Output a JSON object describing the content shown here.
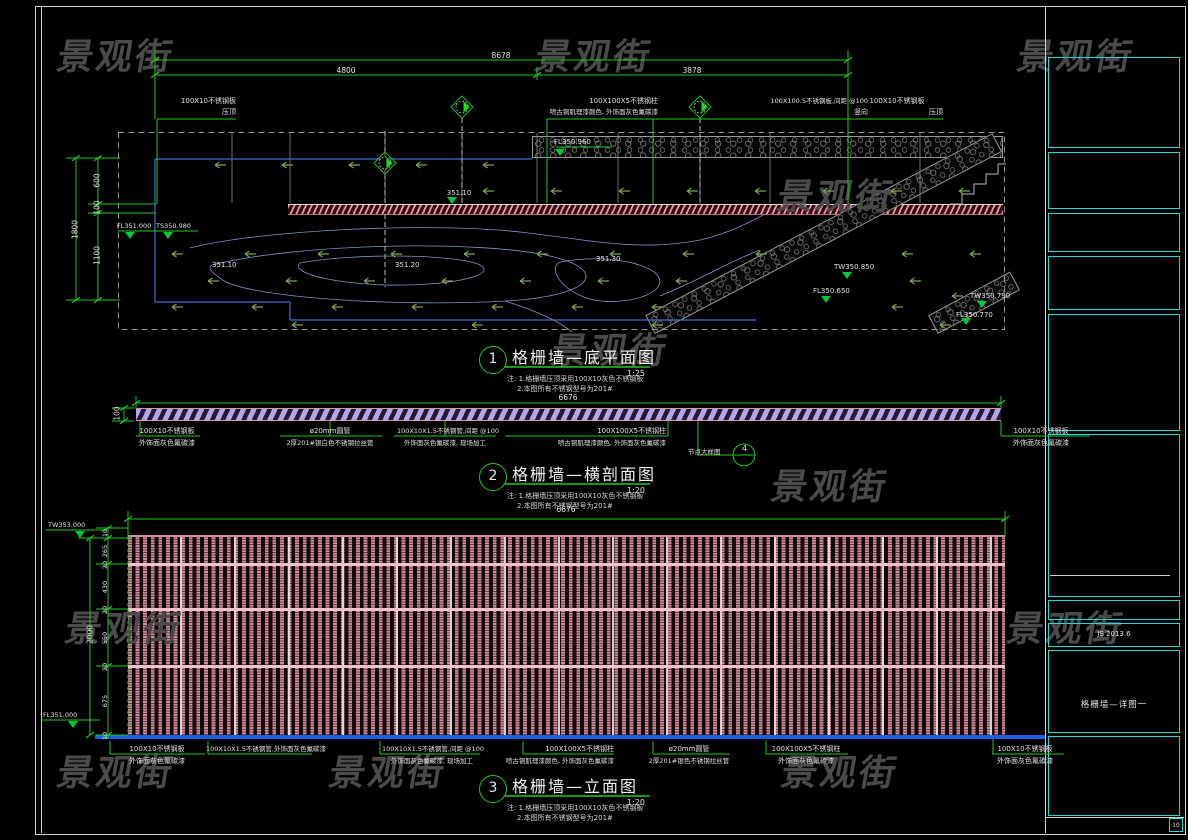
{
  "watermark": {
    "text": "景观街"
  },
  "notes": {
    "l1": "注: 1.格栅墙压顶采用100X10灰色不锈钢板",
    "l2": "2.本图所有不锈钢型号为201#"
  },
  "titleblock": {
    "date": "JS 2013.6",
    "sheet": "格栅墙—详图一",
    "corner": "10"
  },
  "plan": {
    "title": {
      "num": "1",
      "text": "格栅墙—底平面图",
      "scale": "1:25"
    },
    "dims": {
      "total": "8678",
      "seg1": "4800",
      "seg2": "3878",
      "left_total": "1800",
      "left1": "600",
      "left2": "100",
      "left3": "1100"
    },
    "leaders": {
      "cap_left1": "100X10不锈钢板",
      "cap_left2": "压顶",
      "column1": "100X100X5不锈钢柱",
      "column2": "喷古铜肌理漆颜色, 外饰面灰色氟碳漆",
      "plate1": "100X100.5不锈钢板,间距 @100",
      "plate2": "竖向",
      "cap_right1": "100X10不锈钢板",
      "cap_right2": "压顶"
    },
    "spots": {
      "a": "FL350.960",
      "b": "351.10",
      "c": "FL351.000",
      "d": "TS350.980",
      "e": "351.10",
      "f": "351.20",
      "g": "351.30",
      "h": "TW350.850",
      "i": "FL350.650",
      "j": "TW350.790",
      "k": "FL350.770"
    }
  },
  "section": {
    "title": {
      "num": "2",
      "text": "格栅墙—横剖面图",
      "scale": "1:20"
    },
    "dims": {
      "total": "6676",
      "height": "100"
    },
    "leaders": {
      "plate_left1": "100X10不锈钢板",
      "plate_left2": "外饰面灰色氟碳漆",
      "pipe1": "ø20mm圆管",
      "pipe2": "2厚201#银白色不锈钢拉丝管",
      "tube1": "100X10X1.5不锈钢管,间距 @100",
      "tube2": "外饰面灰色氟碳漆, 现场加工",
      "column1": "100X100X5不锈钢柱",
      "column2": "喷古铜肌理漆颜色, 外饰面灰色氟碳漆",
      "plate_right1": "100X10不锈钢板",
      "plate_right2": "外饰面灰色氟碳漆",
      "bubble_label": "节点大样图",
      "bubble_num": "4"
    }
  },
  "elevation": {
    "title": {
      "num": "3",
      "text": "格栅墙—立面图",
      "scale": "1:20"
    },
    "dims": {
      "total": "6676",
      "left_total": "2000",
      "segs": [
        "10",
        "265",
        "20",
        "430",
        "20",
        "550",
        "20",
        "675",
        "10"
      ]
    },
    "levels": {
      "top": "TW353.000",
      "bottom": "FL351.000"
    },
    "leaders": {
      "plate_left1": "100X10不锈钢板",
      "plate_left2": "外饰面灰色氟碳漆",
      "tube_a": "100X10X1.5不锈钢管,外饰面灰色氟碳漆",
      "tube_b1": "100X10X1.5不锈钢管,间距 @100",
      "tube_b2": "外饰面灰色氟碳漆, 现场加工",
      "column1": "100X100X5不锈钢柱",
      "column2": "喷古铜肌理漆颜色, 外饰面灰色氟碳漆",
      "pipe1": "ø20mm圆管",
      "pipe2": "2厚201#银色不锈钢拉丝管",
      "column_b1": "100X100X5不锈钢柱",
      "column_b2": "外饰面灰色氟碳漆",
      "plate_right1": "100X10不锈钢板",
      "plate_right2": "外饰面灰色氟碳漆"
    }
  }
}
